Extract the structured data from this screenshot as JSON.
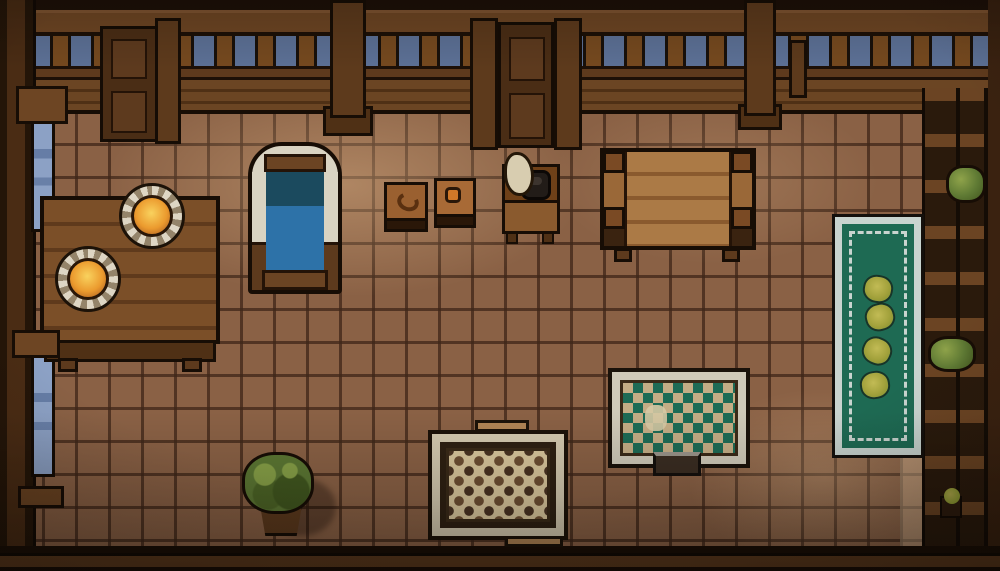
{
  "scene": {
    "name": "pixel-art-tavern-room",
    "description": "Top-down pixel art interior of a wooden tavern room with tiled floor",
    "palette": {
      "floor": "#8a6145",
      "grout": "#3e2618",
      "sky": "#5c7095",
      "beam": "#6d4523",
      "door_wood": "#4a2d15",
      "window_blue": "#8ca1c5",
      "table_wood": "#7b4f28",
      "plate_rim": "#ded6c4",
      "food_glow": "#eb9a2e",
      "bed_blanket_blue": "#2d72a8",
      "bed_sheet_teal": "#1b4a5e",
      "bed_frame_cream": "#d9d3c2",
      "runner_rug_green": "#1e6a53",
      "runner_rug_trim": "#c9d4cf",
      "diamond_rug_green": "#1d6b55",
      "diamond_rug_tan": "#c4ad85",
      "checker_rug_beige": "#d9c69c",
      "plant_green": "#5c7733",
      "flower_olive": "#a3a23c",
      "kettle_black": "#221c18",
      "sack_cream": "#d8cdb0"
    },
    "objects": {
      "door_left": {
        "label": "Wooden door upper left"
      },
      "door_center": {
        "label": "Wooden door upper center"
      },
      "window_upper_left": {
        "label": "Tall blue window upper left wall"
      },
      "window_lower_left": {
        "label": "Tall blue window lower left wall"
      },
      "dining_table": {
        "label": "Wooden dining table with two plates of hot food"
      },
      "plate_1": {
        "label": "Plate with glowing orange food"
      },
      "plate_2": {
        "label": "Plate with glowing orange food"
      },
      "bed": {
        "label": "Bed with blue blanket and cream frame"
      },
      "stool_left": {
        "label": "Small stool with pretzel"
      },
      "stool_right": {
        "label": "Small stool with orange food"
      },
      "nightstand": {
        "label": "Nightstand with black kettle and flour sack"
      },
      "big_table": {
        "label": "Large wooden plank table"
      },
      "runner_rug": {
        "label": "Long green runner rug with four olive flowers"
      },
      "diamond_rug": {
        "label": "Rug with green diamond pattern"
      },
      "checker_rug": {
        "label": "Beige rug with brown checker dots"
      },
      "potted_plant": {
        "label": "Potted green bush plant"
      },
      "shelves_right": {
        "label": "Wooden storage shelves with plants"
      },
      "shelf_plant_upper": {
        "label": "Green plant on upper shelf"
      },
      "shelf_plant_lower": {
        "label": "Green plant on lower shelf"
      },
      "small_flower": {
        "label": "Small potted flower bottom right"
      },
      "railing": {
        "label": "Wooden balustrade railing with sky behind"
      }
    }
  }
}
